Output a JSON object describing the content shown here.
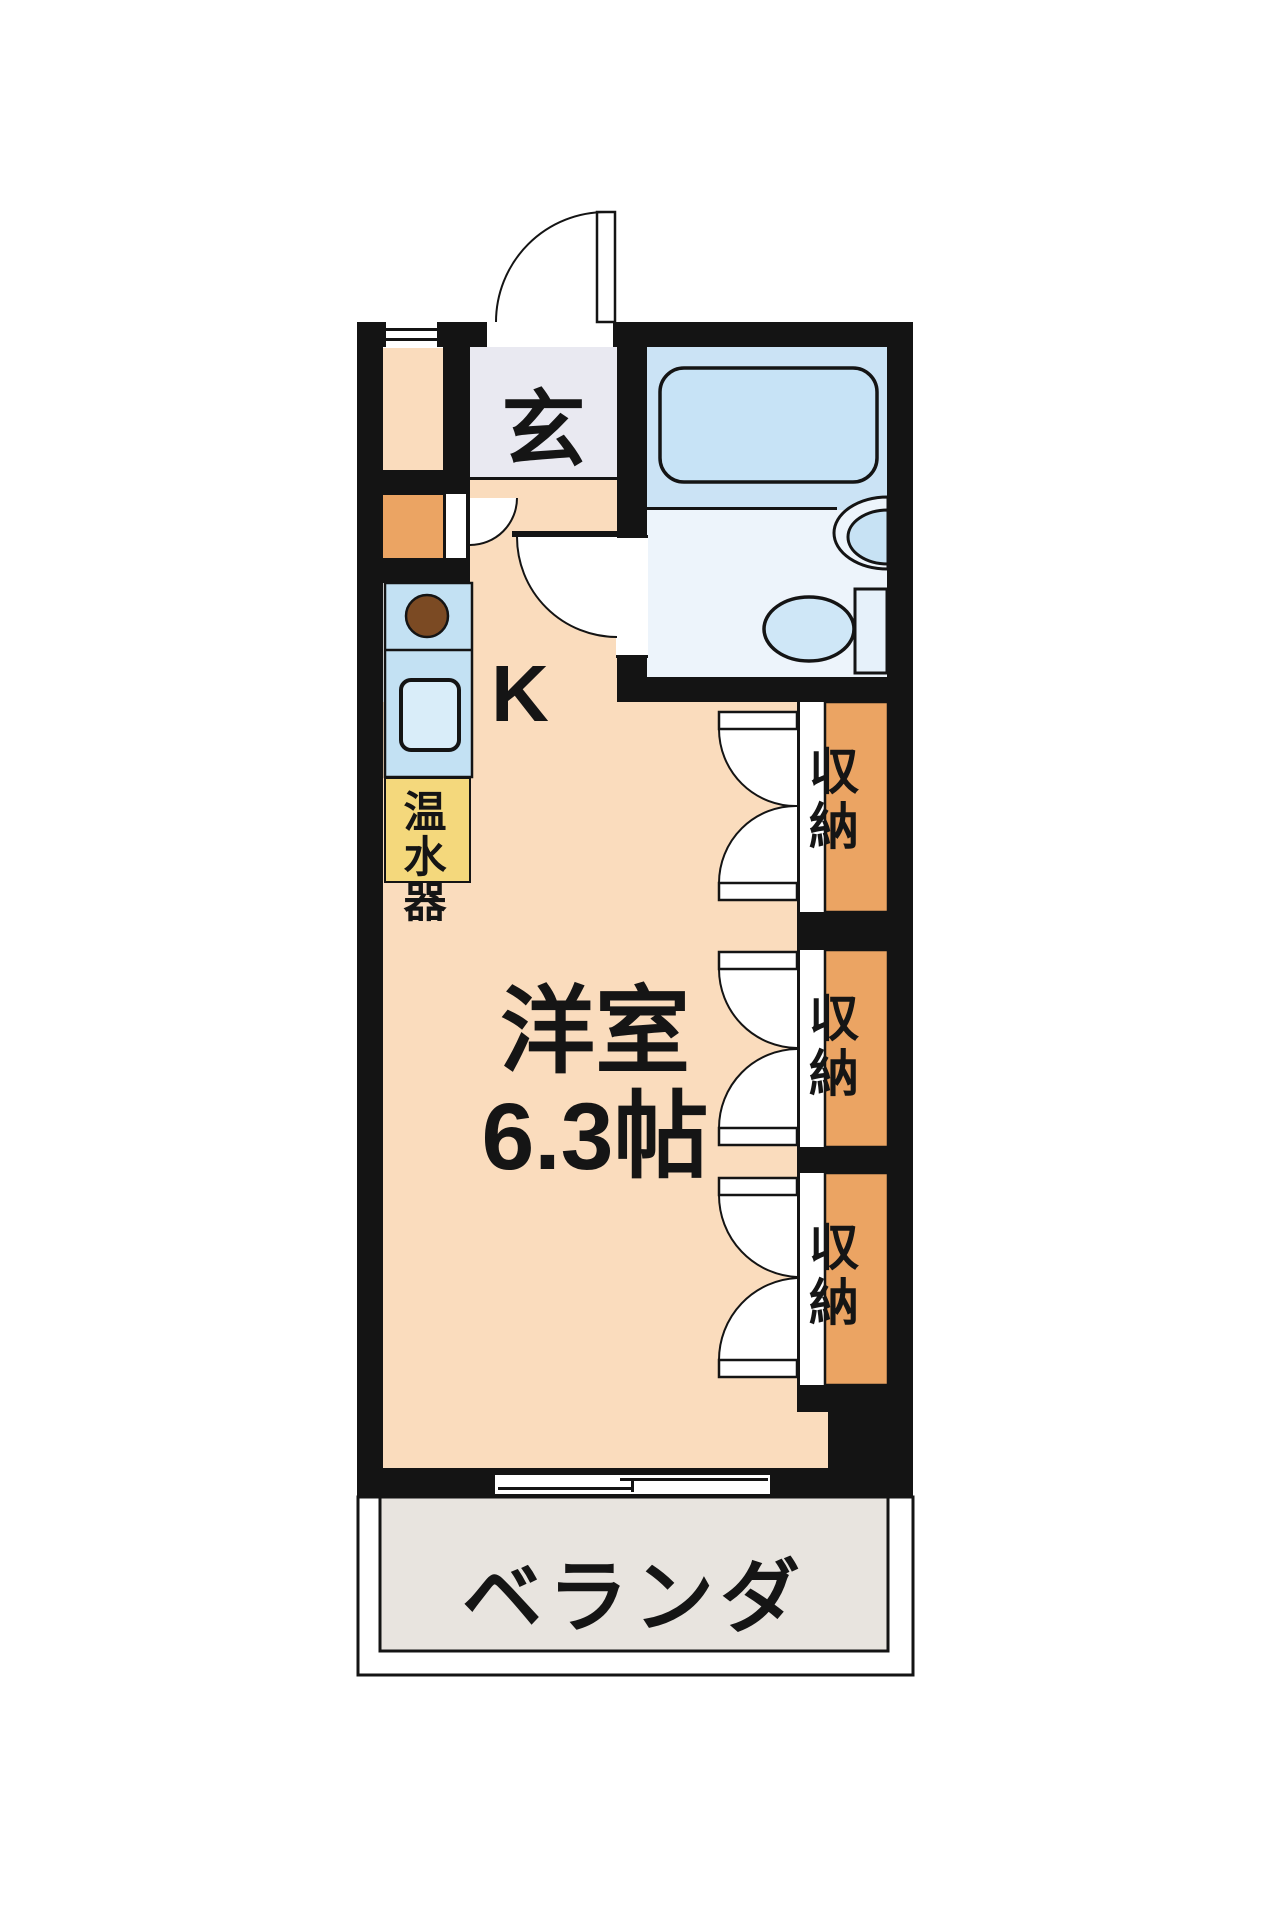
{
  "title": "studio apartment floor plan",
  "plan": {
    "entrance": {
      "label": "玄"
    },
    "kitchen": {
      "label": "K"
    },
    "main_room": {
      "name": "洋室",
      "size": "6.3帖"
    },
    "closets": [
      {
        "label": "収納"
      },
      {
        "label": "収納"
      },
      {
        "label": "収納"
      }
    ],
    "water_heater": {
      "label": "温水器"
    },
    "veranda": {
      "label": "ベランダ"
    },
    "bathroom": {
      "fixtures": [
        "bathtub",
        "wash-basin",
        "toilet"
      ]
    }
  },
  "colors": {
    "wall": "#141414",
    "floor_peach": "#fadcbd",
    "closet_orange": "#eba463",
    "bathroom_upper_blue": "#cbe3f5",
    "bathroom_lower_blue": "#edf4fb",
    "fixture_blue": "#c7e3f6",
    "kitchen_counter_blue": "#c3e1f3",
    "water_heater_yellow": "#f4d87c",
    "entrance_gray": "#e9e9f1",
    "veranda_gray": "#e8e4df",
    "stove_brown": "#7b4a23"
  }
}
